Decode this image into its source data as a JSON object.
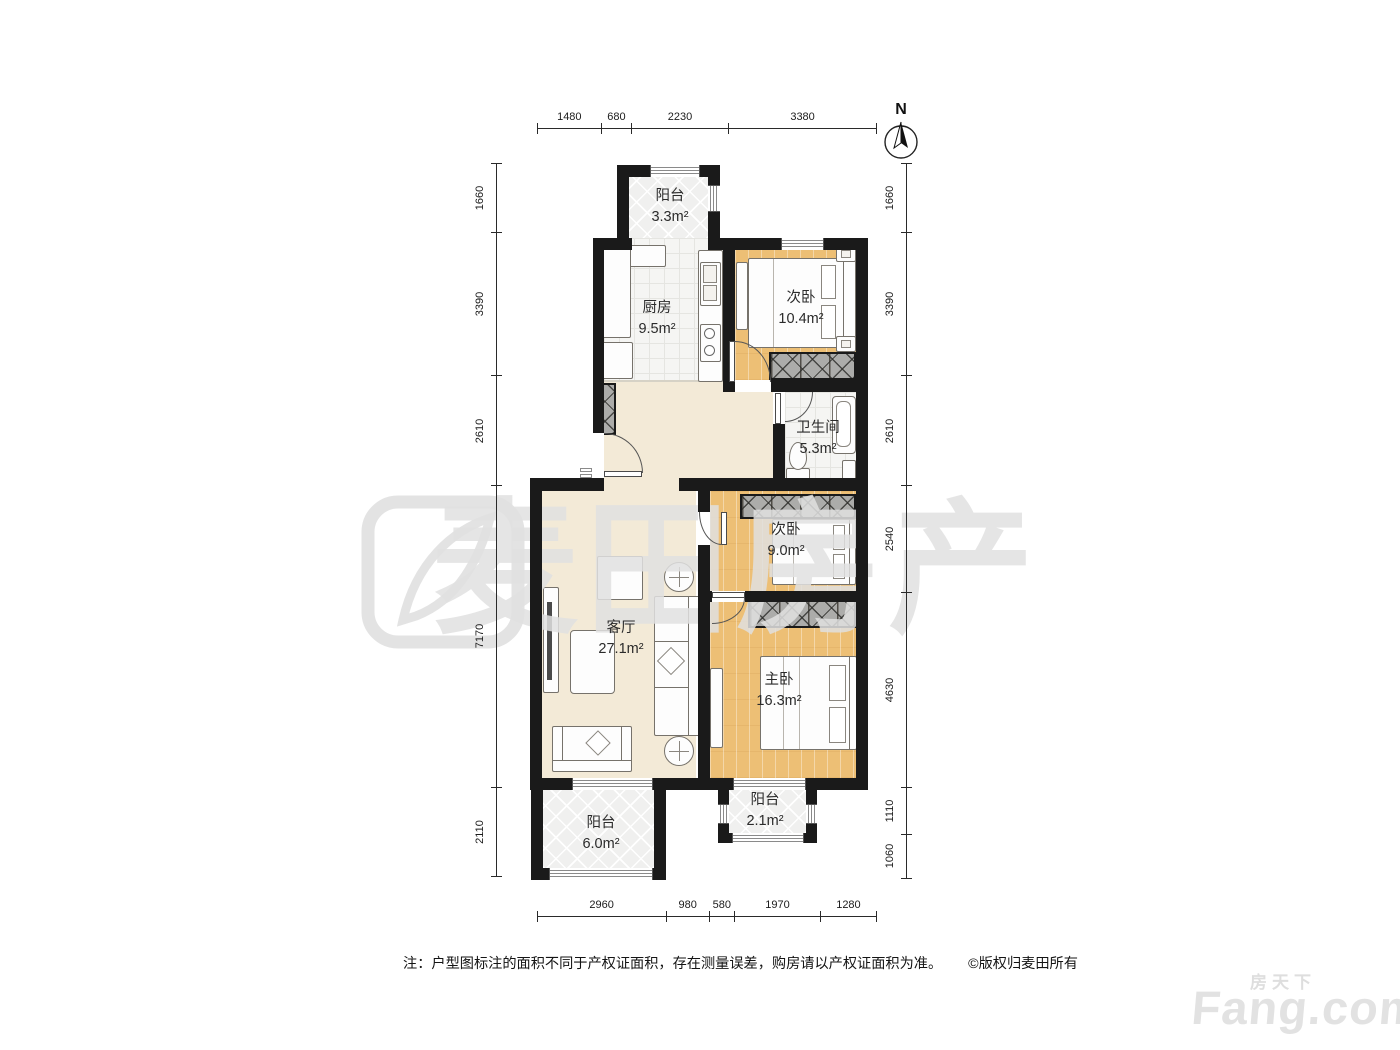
{
  "compass": {
    "label": "N"
  },
  "watermark": {
    "text": "麦田房产"
  },
  "brand": {
    "cn": "房天下",
    "en": "Fang.com"
  },
  "note": {
    "text": "注：户型图标注的面积不同于产权证面积，存在测量误差，购房请以产权证面积为准。",
    "copyright": "©版权归麦田所有"
  },
  "rooms": {
    "balcony_top": {
      "name": "阳台",
      "area": "3.3m²"
    },
    "kitchen": {
      "name": "厨房",
      "area": "9.5m²"
    },
    "bedroom_a": {
      "name": "次卧",
      "area": "10.4m²"
    },
    "bathroom": {
      "name": "卫生间",
      "area": "5.3m²"
    },
    "bedroom_b": {
      "name": "次卧",
      "area": "9.0m²"
    },
    "living": {
      "name": "客厅",
      "area": "27.1m²"
    },
    "master": {
      "name": "主卧",
      "area": "16.3m²"
    },
    "balcony_right": {
      "name": "阳台",
      "area": "2.1m²"
    },
    "balcony_left": {
      "name": "阳台",
      "area": "6.0m²"
    }
  },
  "dimensions": {
    "top": [
      "1480",
      "680",
      "2230",
      "3380"
    ],
    "bottom": [
      "2960",
      "980",
      "580",
      "1970",
      "1280"
    ],
    "left": [
      "1660",
      "3390",
      "2610",
      "7170",
      "2110"
    ],
    "right": [
      "1660",
      "3390",
      "2610",
      "2540",
      "4630",
      "1110",
      "1060"
    ]
  },
  "colors": {
    "wall": "#1A1A1A",
    "wood_floor": "#EDBF75",
    "beige_floor": "#F3EAD7",
    "tile_floor": "#F5F5F3",
    "balcony_floor": "#F0F0EF",
    "wardrobe": "#ACACAA",
    "watermark": "#E1E1E1",
    "dimension_text": "#1B1B1B"
  }
}
